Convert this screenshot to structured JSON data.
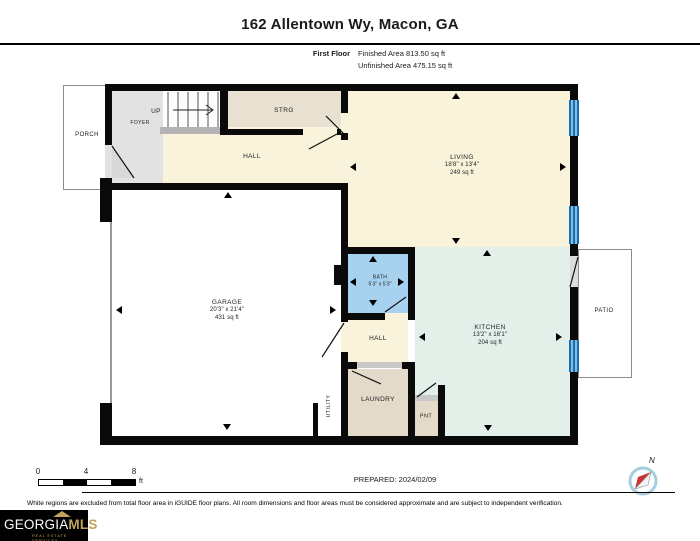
{
  "header": {
    "title": "162 Allentown Wy, Macon, GA",
    "floor_label": "First Floor",
    "finished_area": "Finished Area 813.50 sq ft",
    "unfinished_area": "Unfinished Area 475.15 sq ft"
  },
  "rooms": {
    "porch": {
      "label": "PORCH"
    },
    "foyer": {
      "label": "FOYER"
    },
    "up": {
      "label": "UP"
    },
    "strg": {
      "label": "STRG"
    },
    "hall_upper": {
      "label": "HALL"
    },
    "living": {
      "label": "LIVING",
      "dims": "18'8\" x 13'4\"",
      "area": "249 sq ft"
    },
    "garage": {
      "label": "GARAGE",
      "dims": "20'3\" x 21'4\"",
      "area": "431 sq ft"
    },
    "bath": {
      "label": "BATH",
      "dims": "5'3\" x 5'3\""
    },
    "kitchen": {
      "label": "KITCHEN",
      "dims": "13'2\" x 16'1\"",
      "area": "204 sq ft"
    },
    "hall_lower": {
      "label": "HALL"
    },
    "laundry": {
      "label": "LAUNDRY"
    },
    "pnt": {
      "label": "PNT"
    },
    "utility": {
      "label": "UTILITY"
    },
    "patio": {
      "label": "PATIO"
    }
  },
  "scale_bar": {
    "tick0": "0",
    "tick1": "4",
    "tick2": "8",
    "unit": "ft"
  },
  "footer": {
    "prepared": "PREPARED: 2024/02/09",
    "disclaimer": "White regions are excluded from total floor area in iGUIDE floor plans. All room dimensions and floor areas must be considered approximate and are subject to independent verification.",
    "compass_n": "N"
  },
  "logo": {
    "name_main": "GEORGIA",
    "name_accent": "MLS",
    "tagline": "REAL ESTATE SERVICES"
  },
  "colors": {
    "wall": "#0a0a0a",
    "finished_floor_cream": "#faf3dc",
    "storage_tan": "#e8e0d0",
    "laundry_tan": "#e3daca",
    "foyer_gray": "#e2e2e2",
    "bath_blue": "#a6d2ef",
    "kitchen_mint": "#e3efe9",
    "window_blue": "#1c6fad",
    "logo_gold": "#c2a25c"
  }
}
